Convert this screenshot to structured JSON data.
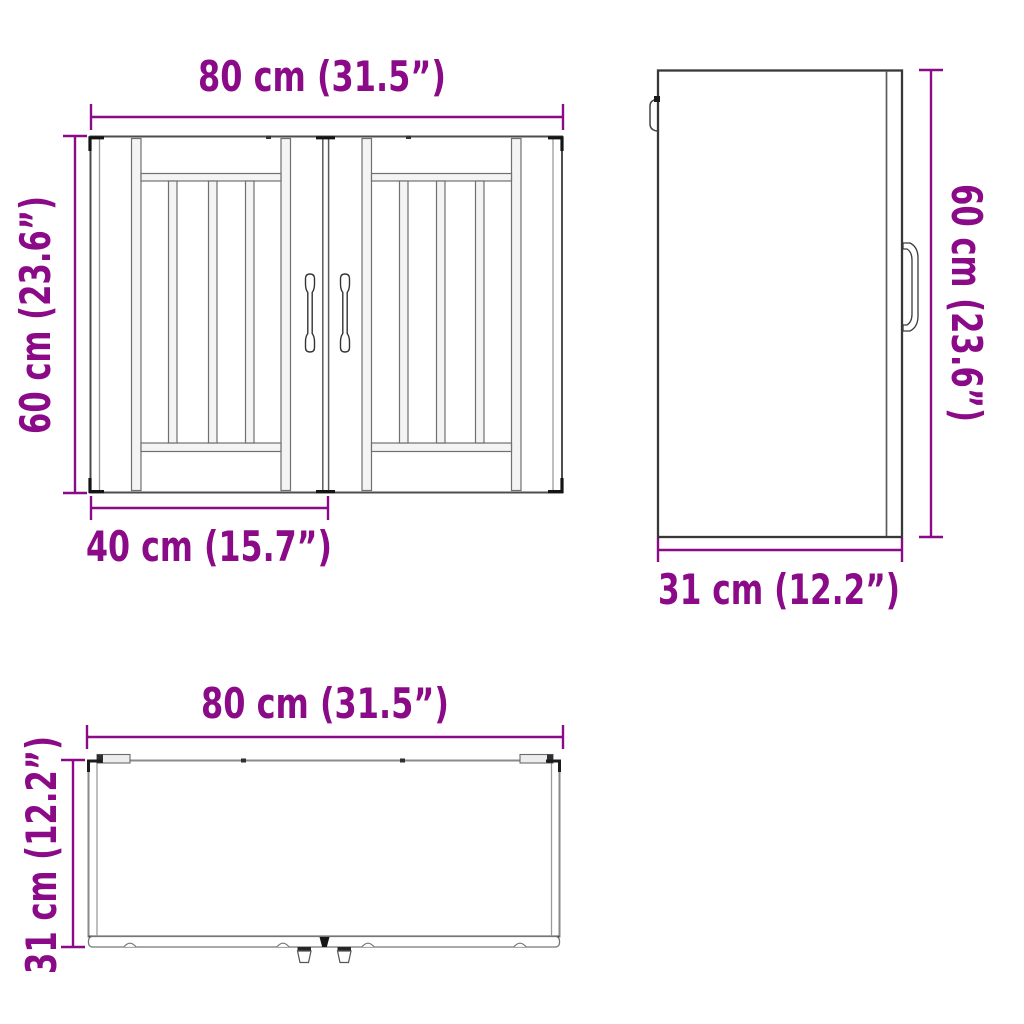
{
  "colors": {
    "dimension": "#8A0A87",
    "outline_dark": "#2E2E2E",
    "line_mid": "#5B5B5B",
    "line_light": "#9A9A9A",
    "panel_fill": "#F4F4F4",
    "background": "#FFFFFF"
  },
  "front_view": {
    "width_label": "80 cm (31.5”)",
    "height_label": "60 cm (23.6”)",
    "door_width_label": "40 cm (15.7”)"
  },
  "side_view": {
    "height_label": "60 cm (23.6”)",
    "depth_label": "31 cm (12.2”)"
  },
  "bottom_view": {
    "width_label": "80 cm (31.5”)",
    "depth_label": "31 cm (12.2”)"
  }
}
